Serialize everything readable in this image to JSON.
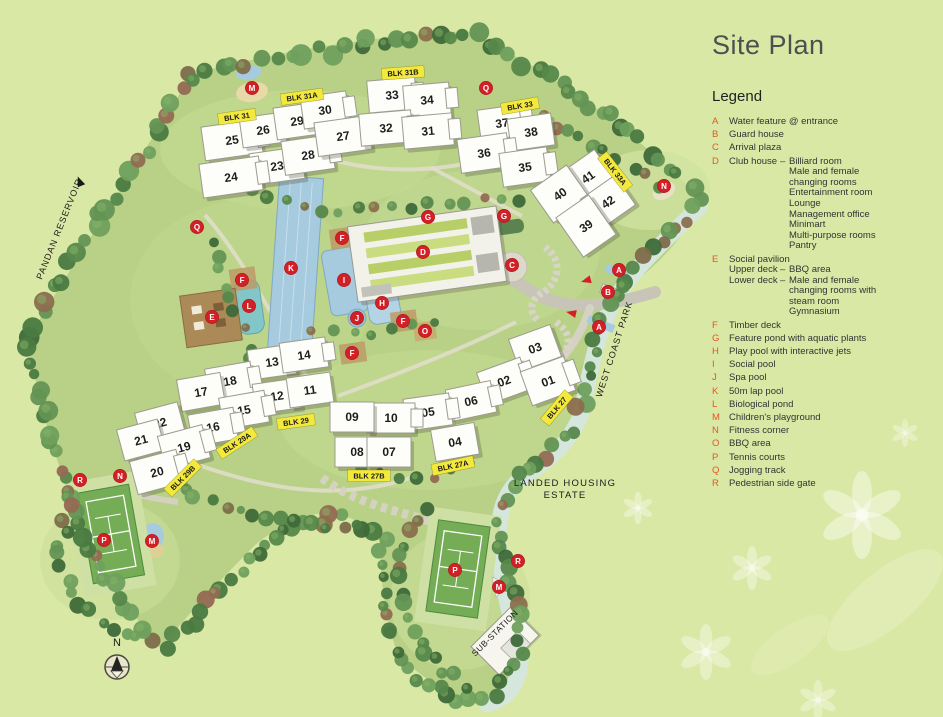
{
  "title": "Site Plan",
  "legend": {
    "heading": "Legend",
    "items": [
      {
        "key": "A",
        "text": "Water feature @ entrance"
      },
      {
        "key": "B",
        "text": "Guard house"
      },
      {
        "key": "C",
        "text": "Arrival plaza"
      },
      {
        "key": "D",
        "text": "Club house",
        "dash": "–",
        "details": [
          "Billiard room",
          "Male and female",
          "changing rooms",
          "Entertainment room",
          "Lounge",
          "Management office",
          "Minimart",
          "Multi-purpose rooms",
          "Pantry"
        ]
      },
      {
        "key": "E",
        "text": "Social pavilion",
        "rows": [
          {
            "left": "Upper deck",
            "dash": "–",
            "lines": [
              "BBQ area"
            ]
          },
          {
            "left": "Lower deck",
            "dash": "–",
            "lines": [
              "Male and female",
              "changing rooms with",
              "steam room"
            ]
          },
          {
            "left": "",
            "dash": "",
            "lines": [
              "Gymnasium"
            ]
          }
        ]
      },
      {
        "key": "F",
        "text": "Timber deck"
      },
      {
        "key": "G",
        "text": "Feature pond with aquatic plants"
      },
      {
        "key": "H",
        "text": "Play pool with interactive jets"
      },
      {
        "key": "I",
        "text": "Social pool"
      },
      {
        "key": "J",
        "text": "Spa pool"
      },
      {
        "key": "K",
        "text": "50m lap pool"
      },
      {
        "key": "L",
        "text": "Biological pond"
      },
      {
        "key": "M",
        "text": "Children's playground"
      },
      {
        "key": "N",
        "text": "Fitness corner"
      },
      {
        "key": "O",
        "text": "BBQ area"
      },
      {
        "key": "P",
        "text": "Tennis courts"
      },
      {
        "key": "Q",
        "text": "Jogging track"
      },
      {
        "key": "R",
        "text": "Pedestrian side gate"
      }
    ]
  },
  "map": {
    "buildings": [
      {
        "n": "25",
        "x": 232,
        "y": 140,
        "r": -8,
        "w": 58,
        "h": 34
      },
      {
        "n": "26",
        "x": 263,
        "y": 130,
        "r": -8,
        "w": 44,
        "h": 30
      },
      {
        "n": "23",
        "x": 277,
        "y": 166,
        "r": -8,
        "w": 52,
        "h": 32
      },
      {
        "n": "24",
        "x": 231,
        "y": 177,
        "r": -8,
        "w": 60,
        "h": 34
      },
      {
        "n": "29",
        "x": 297,
        "y": 121,
        "r": -8,
        "w": 44,
        "h": 32
      },
      {
        "n": "30",
        "x": 325,
        "y": 110,
        "r": -8,
        "w": 46,
        "h": 32
      },
      {
        "n": "28",
        "x": 308,
        "y": 155,
        "r": -8,
        "w": 50,
        "h": 34
      },
      {
        "n": "27",
        "x": 343,
        "y": 136,
        "r": -8,
        "w": 54,
        "h": 34
      },
      {
        "n": "33",
        "x": 392,
        "y": 95,
        "r": -5,
        "w": 48,
        "h": 32
      },
      {
        "n": "34",
        "x": 427,
        "y": 100,
        "r": -5,
        "w": 46,
        "h": 32
      },
      {
        "n": "32",
        "x": 386,
        "y": 128,
        "r": -5,
        "w": 52,
        "h": 32
      },
      {
        "n": "31",
        "x": 428,
        "y": 131,
        "r": -5,
        "w": 50,
        "h": 32
      },
      {
        "n": "37",
        "x": 502,
        "y": 123,
        "r": -8,
        "w": 46,
        "h": 32
      },
      {
        "n": "38",
        "x": 531,
        "y": 132,
        "r": -8,
        "w": 44,
        "h": 32
      },
      {
        "n": "36",
        "x": 484,
        "y": 153,
        "r": -8,
        "w": 50,
        "h": 34
      },
      {
        "n": "35",
        "x": 525,
        "y": 167,
        "r": -8,
        "w": 48,
        "h": 34
      },
      {
        "n": "41",
        "x": 588,
        "y": 177,
        "r": -35,
        "w": 42,
        "h": 38
      },
      {
        "n": "40",
        "x": 560,
        "y": 194,
        "r": -35,
        "w": 44,
        "h": 40
      },
      {
        "n": "42",
        "x": 608,
        "y": 202,
        "r": -35,
        "w": 42,
        "h": 36
      },
      {
        "n": "39",
        "x": 586,
        "y": 226,
        "r": -35,
        "w": 40,
        "h": 48
      },
      {
        "n": "13",
        "x": 272,
        "y": 362,
        "r": -8,
        "w": 46,
        "h": 30
      },
      {
        "n": "14",
        "x": 304,
        "y": 355,
        "r": -8,
        "w": 46,
        "h": 30
      },
      {
        "n": "18",
        "x": 230,
        "y": 381,
        "r": -10,
        "w": 46,
        "h": 32
      },
      {
        "n": "17",
        "x": 201,
        "y": 392,
        "r": -10,
        "w": 44,
        "h": 32
      },
      {
        "n": "12",
        "x": 277,
        "y": 396,
        "r": -8,
        "w": 46,
        "h": 30
      },
      {
        "n": "11",
        "x": 310,
        "y": 390,
        "r": -8,
        "w": 44,
        "h": 30
      },
      {
        "n": "15",
        "x": 244,
        "y": 410,
        "r": -10,
        "w": 46,
        "h": 32
      },
      {
        "n": "16",
        "x": 213,
        "y": 427,
        "r": -10,
        "w": 46,
        "h": 32
      },
      {
        "n": "22",
        "x": 160,
        "y": 423,
        "r": -15,
        "w": 44,
        "h": 32
      },
      {
        "n": "21",
        "x": 141,
        "y": 440,
        "r": -15,
        "w": 42,
        "h": 32
      },
      {
        "n": "19",
        "x": 184,
        "y": 447,
        "r": -15,
        "w": 46,
        "h": 34
      },
      {
        "n": "20",
        "x": 157,
        "y": 472,
        "r": -15,
        "w": 48,
        "h": 34
      },
      {
        "n": "03",
        "x": 535,
        "y": 348,
        "r": -20,
        "w": 44,
        "h": 34
      },
      {
        "n": "02",
        "x": 504,
        "y": 381,
        "r": -20,
        "w": 46,
        "h": 34
      },
      {
        "n": "01",
        "x": 548,
        "y": 381,
        "r": -20,
        "w": 46,
        "h": 36
      },
      {
        "n": "06",
        "x": 471,
        "y": 401,
        "r": -12,
        "w": 46,
        "h": 32
      },
      {
        "n": "05",
        "x": 428,
        "y": 412,
        "r": -8,
        "w": 46,
        "h": 32
      },
      {
        "n": "04",
        "x": 455,
        "y": 442,
        "r": -10,
        "w": 44,
        "h": 32
      },
      {
        "n": "10",
        "x": 391,
        "y": 418,
        "r": 0,
        "w": 48,
        "h": 30
      },
      {
        "n": "09",
        "x": 352,
        "y": 417,
        "r": 0,
        "w": 44,
        "h": 30
      },
      {
        "n": "08",
        "x": 357,
        "y": 452,
        "r": 0,
        "w": 44,
        "h": 30
      },
      {
        "n": "07",
        "x": 389,
        "y": 452,
        "r": 0,
        "w": 44,
        "h": 30
      }
    ],
    "blk_labels": [
      {
        "text": "BLK 31",
        "x": 237,
        "y": 117,
        "rot": -8
      },
      {
        "text": "BLK 31A",
        "x": 302,
        "y": 97,
        "rot": -8
      },
      {
        "text": "BLK 31B",
        "x": 403,
        "y": 73,
        "rot": -4
      },
      {
        "text": "BLK 33",
        "x": 520,
        "y": 106,
        "rot": -10
      },
      {
        "text": "BLK 33A",
        "x": 615,
        "y": 172,
        "rot": 52
      },
      {
        "text": "BLK 27",
        "x": 557,
        "y": 408,
        "rot": -50
      },
      {
        "text": "BLK 29",
        "x": 296,
        "y": 422,
        "rot": -8
      },
      {
        "text": "BLK 29A",
        "x": 237,
        "y": 443,
        "rot": -33
      },
      {
        "text": "BLK 29B",
        "x": 183,
        "y": 478,
        "rot": -45
      },
      {
        "text": "BLK 27A",
        "x": 453,
        "y": 466,
        "rot": -12
      },
      {
        "text": "BLK 27B",
        "x": 369,
        "y": 476,
        "rot": 0
      }
    ],
    "markers": [
      {
        "l": "M",
        "x": 252,
        "y": 88
      },
      {
        "l": "Q",
        "x": 486,
        "y": 88
      },
      {
        "l": "Q",
        "x": 197,
        "y": 227
      },
      {
        "l": "N",
        "x": 664,
        "y": 186
      },
      {
        "l": "G",
        "x": 428,
        "y": 217
      },
      {
        "l": "G",
        "x": 504,
        "y": 216
      },
      {
        "l": "D",
        "x": 423,
        "y": 252
      },
      {
        "l": "C",
        "x": 512,
        "y": 265
      },
      {
        "l": "F",
        "x": 342,
        "y": 238
      },
      {
        "l": "F",
        "x": 242,
        "y": 280
      },
      {
        "l": "K",
        "x": 291,
        "y": 268
      },
      {
        "l": "I",
        "x": 344,
        "y": 280
      },
      {
        "l": "L",
        "x": 249,
        "y": 306
      },
      {
        "l": "E",
        "x": 212,
        "y": 317
      },
      {
        "l": "H",
        "x": 382,
        "y": 303
      },
      {
        "l": "J",
        "x": 357,
        "y": 318
      },
      {
        "l": "F",
        "x": 403,
        "y": 321
      },
      {
        "l": "O",
        "x": 425,
        "y": 331
      },
      {
        "l": "F",
        "x": 352,
        "y": 353
      },
      {
        "l": "A",
        "x": 619,
        "y": 270
      },
      {
        "l": "B",
        "x": 608,
        "y": 292
      },
      {
        "l": "A",
        "x": 599,
        "y": 327
      },
      {
        "l": "R",
        "x": 80,
        "y": 480
      },
      {
        "l": "N",
        "x": 120,
        "y": 476
      },
      {
        "l": "P",
        "x": 104,
        "y": 540
      },
      {
        "l": "M",
        "x": 152,
        "y": 541
      },
      {
        "l": "P",
        "x": 455,
        "y": 570
      },
      {
        "l": "M",
        "x": 499,
        "y": 587
      },
      {
        "l": "R",
        "x": 518,
        "y": 561
      }
    ],
    "area_texts": [
      {
        "text": "PANDAN RESERVOIR",
        "x": 62,
        "y": 230,
        "rot": -68,
        "size": 9,
        "ls": 1
      },
      {
        "text": "WEST COAST PARK",
        "x": 617,
        "y": 350,
        "rot": -72,
        "size": 9,
        "ls": 1
      },
      {
        "text": "LANDED HOUSING",
        "x": 565,
        "y": 486,
        "rot": 0,
        "size": 9.5,
        "ls": 1.2
      },
      {
        "text": "ESTATE",
        "x": 565,
        "y": 498,
        "rot": 0,
        "size": 9.5,
        "ls": 1.2
      },
      {
        "text": "SUB-STATION",
        "x": 497,
        "y": 635,
        "rot": -45,
        "size": 8.5,
        "ls": 0.5
      },
      {
        "text": "N",
        "x": 117,
        "y": 646,
        "rot": 0,
        "size": 11,
        "ls": 0
      }
    ]
  },
  "colors": {
    "background": "#dae8a5",
    "map_green": "#b8d186",
    "marker_red": "#d32027",
    "blk_yellow": "#f2e93c",
    "legend_letter": "#dd5a26",
    "pool_blue": "#a6cade",
    "pond_turquoise": "#82c6c8",
    "building_white": "#fdfdf9"
  }
}
